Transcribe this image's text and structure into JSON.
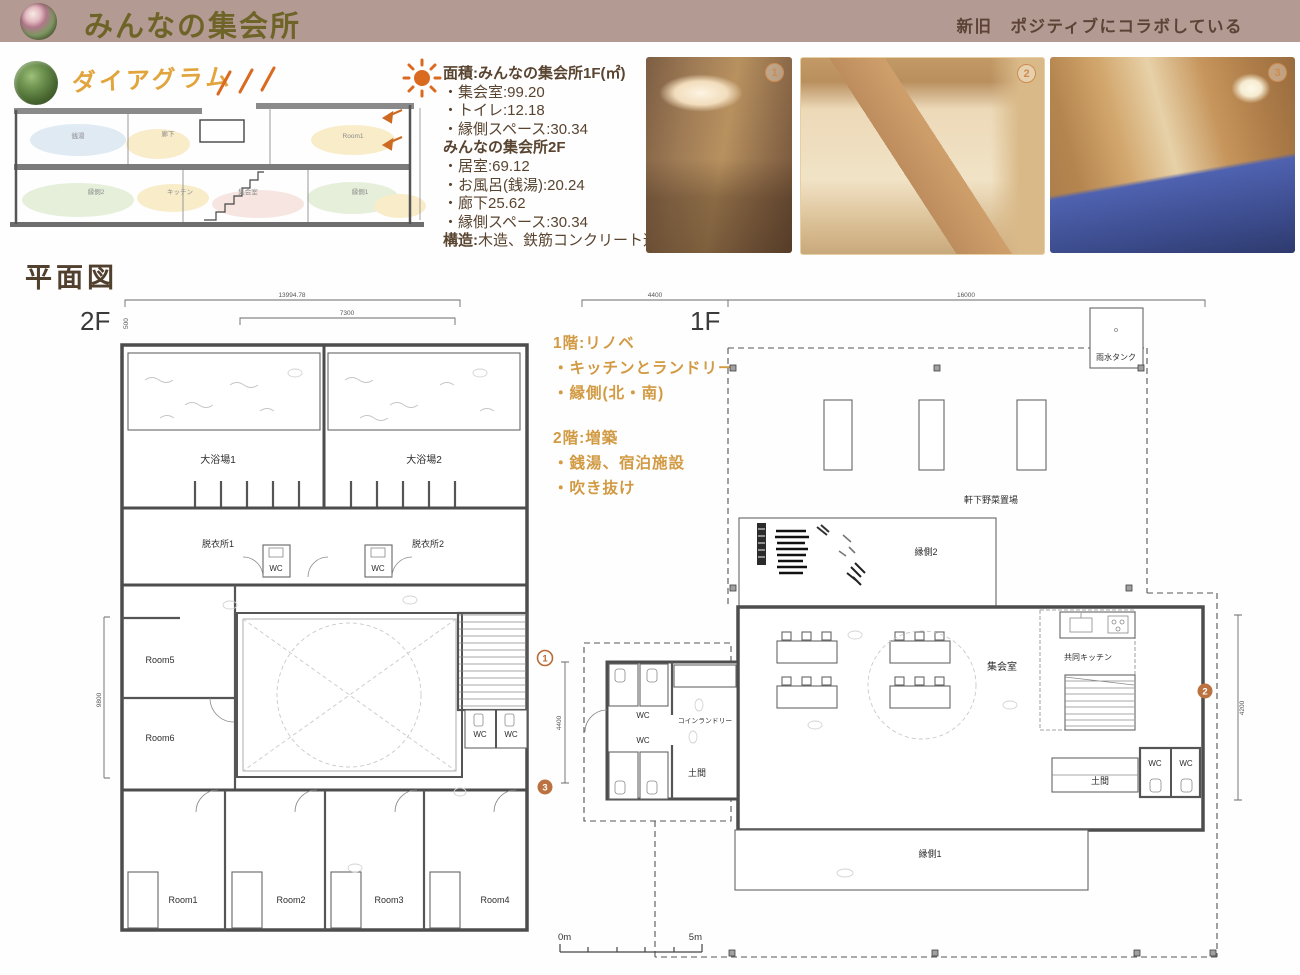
{
  "header": {
    "title": "みんなの集会所",
    "tagline": "新旧　ポジティブにコラボしている"
  },
  "diagram": {
    "heading": "ダイアグラム",
    "labels": {
      "f2_bath": "銭湯",
      "f2_hall": "廊下",
      "f2_room": "Room1",
      "f1_engawa2": "縁側2",
      "f1_kitchen": "キッチン",
      "f1_meeting": "集会室",
      "f1_engawa1": "縁側1"
    }
  },
  "area_info": {
    "lines": [
      {
        "b": "面積:みんなの集会所1F(㎡)",
        "t": ""
      },
      {
        "b": "",
        "t": "・集会室:99.20"
      },
      {
        "b": "",
        "t": "・トイレ:12.18"
      },
      {
        "b": "",
        "t": "・縁側スペース:30.34"
      },
      {
        "b": "みんなの集会所2F",
        "t": ""
      },
      {
        "b": "",
        "t": "・居室:69.12"
      },
      {
        "b": "",
        "t": "・お風呂(銭湯):20.24"
      },
      {
        "b": "",
        "t": "・廊下25.62"
      },
      {
        "b": "",
        "t": "・縁側スペース:30.34"
      },
      {
        "b": "構造:",
        "t": "木造、鉄筋コンクリート造"
      }
    ]
  },
  "photos": [
    {
      "number": "1"
    },
    {
      "number": "2"
    },
    {
      "number": "3"
    }
  ],
  "plans": {
    "heading": "平面図",
    "notes": {
      "n1": "1階:リノベ",
      "n2": "・キッチンとランドリー",
      "n3": "・縁側(北・南)",
      "n4": "2階:増築",
      "n5": "・銭湯、宿泊施設",
      "n6": "・吹き抜け"
    },
    "f2": {
      "label": "2F",
      "dims": {
        "total_width": "13994.78",
        "inner_width": "7300",
        "offset": "500",
        "left_height": "9800",
        "right_height": "4400"
      },
      "rooms": {
        "bath1": "大浴場1",
        "bath2": "大浴場2",
        "dressing1": "脱衣所1",
        "dressing2": "脱衣所2",
        "wc": "WC",
        "room5": "Room5",
        "room6": "Room6",
        "room1": "Room1",
        "room2": "Room2",
        "room3": "Room3",
        "room4": "Room4"
      },
      "markers": {
        "m1": "1",
        "m3": "3"
      }
    },
    "f1": {
      "label": "1F",
      "dims": {
        "left_width": "4400",
        "main_width": "16000",
        "right_height": "4200"
      },
      "rooms": {
        "rain_tank": "雨水タンク",
        "veggie": "軒下野菜置場",
        "engawa2": "縁側2",
        "meeting": "集会室",
        "kitchen": "共同キッチン",
        "laundry": "コインランドリー",
        "doma": "土間",
        "wc": "WC",
        "engawa1": "縁側1"
      },
      "markers": {
        "m2": "2"
      }
    },
    "scalebar": {
      "start": "0m",
      "end": "5m"
    }
  }
}
